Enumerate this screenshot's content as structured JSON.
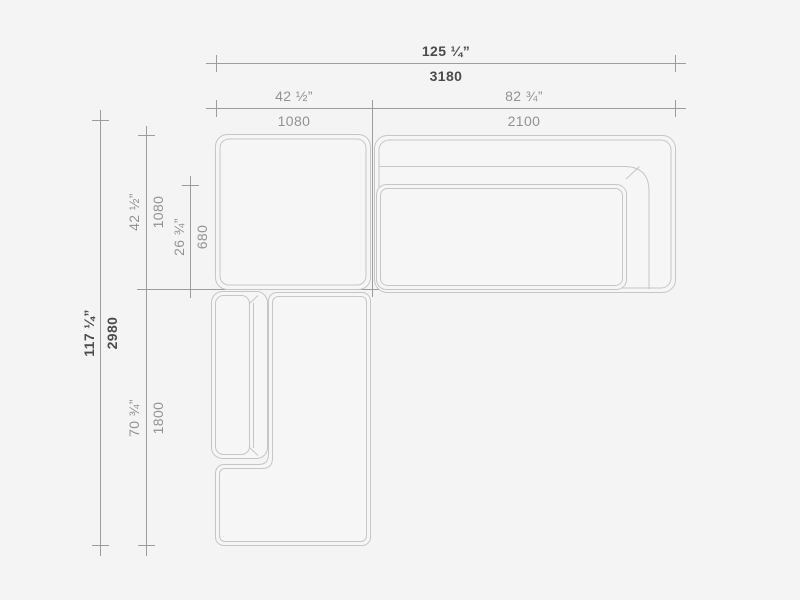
{
  "canvas": {
    "background_color": "#f4f4f4",
    "sofa_line_color": "#c6c6c6",
    "dimension_line_color": "#9d9d9d",
    "overall_dimension_text_color": "#4b4b4b",
    "component_dimension_text_color": "#929292"
  },
  "dimensions": {
    "overall_width": {
      "inches": "125 ¼”",
      "mm": "3180"
    },
    "corner_module_width": {
      "inches": "42 ½”",
      "mm": "1080"
    },
    "sofa_module_width": {
      "inches": "82 ¾”",
      "mm": "2100"
    },
    "overall_depth": {
      "inches": "117 ¼”",
      "mm": "2980"
    },
    "corner_module_depth": {
      "inches": "42 ½”",
      "mm": "1080"
    },
    "seat_depth": {
      "inches": "26 ¾”",
      "mm": "680"
    },
    "chaise_module_length": {
      "inches": "70 ¾”",
      "mm": "1800"
    }
  }
}
